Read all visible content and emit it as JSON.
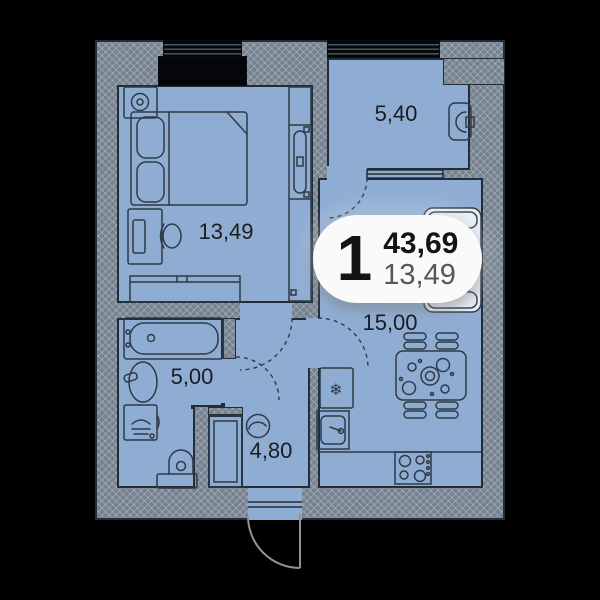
{
  "plan": {
    "unit_badge": {
      "rooms_count": "1",
      "total_area": "43,69",
      "living_area": "13,49"
    },
    "room_labels": {
      "bedroom": "13,49",
      "loggia": "5,40",
      "kitchen_living": "15,00",
      "bathroom": "5,00",
      "hallway": "4,80"
    },
    "icons": {
      "fridge_snowflake": "❄"
    },
    "colors": {
      "background": "#000000",
      "room_fill": "#8fadd3",
      "wall_fill": "#76828f",
      "outline": "#232d38",
      "furniture_stroke": "#2e3a46",
      "label_text": "#1b1d20",
      "badge_bg": "#fafafa",
      "badge_text": "#141414",
      "badge_secondary": "#54575c",
      "sofa_fill": "#e8eef6",
      "window_glass": "#05080b"
    }
  }
}
